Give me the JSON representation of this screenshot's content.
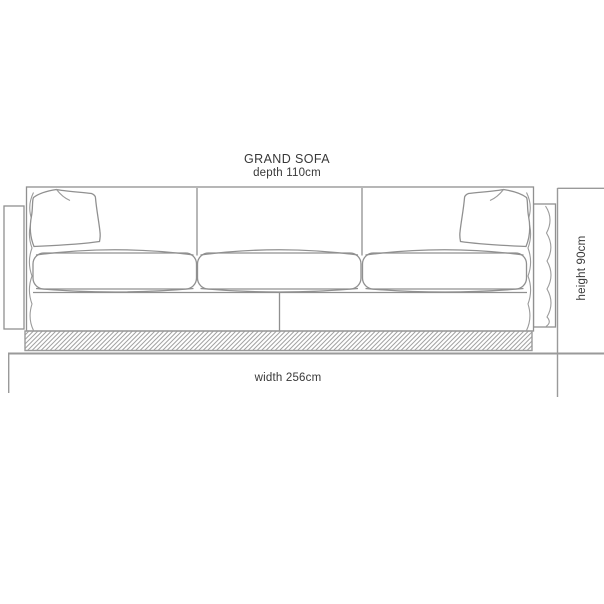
{
  "annotation": {
    "title": "GRAND SOFA",
    "depth_label": "depth 110cm"
  },
  "dimension_labels": {
    "width": "width 256cm",
    "height": "height 90cm"
  },
  "drawing": {
    "type": "front-elevation-technical-drawing",
    "subject": "three-seat sofa with two arm panels, three seat cushions, two back pillows, hatched plinth"
  },
  "colors": {
    "line": "#909090",
    "line_strong": "#9a9a9a",
    "text": "#383838",
    "background": "#ffffff"
  }
}
